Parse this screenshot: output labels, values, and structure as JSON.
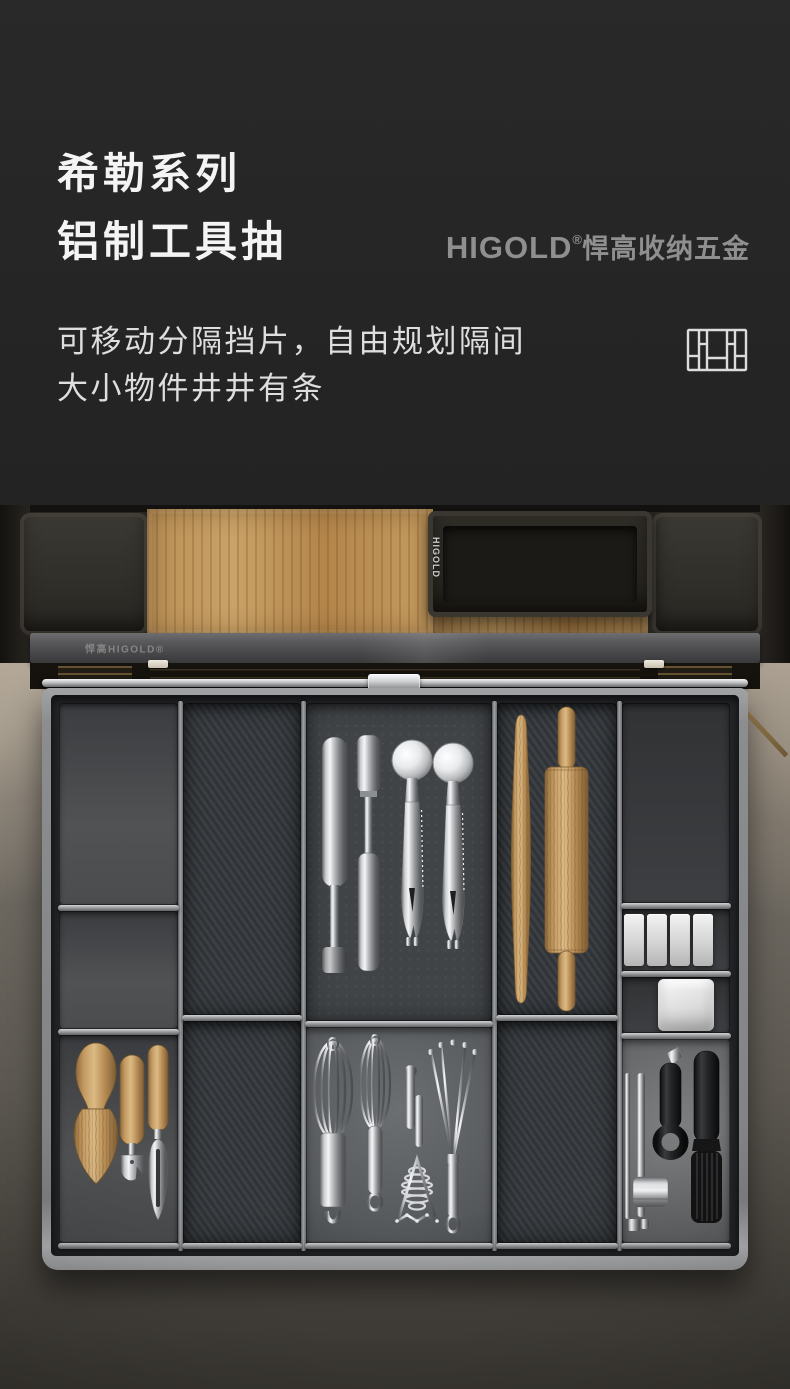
{
  "hero": {
    "title_line1": "希勒系列",
    "title_line2": "铝制工具抽",
    "brand_name": "HIGOLD",
    "brand_reg": "®",
    "brand_suffix": "悍高收纳五金",
    "desc_line1": "可移动分隔挡片，自由规划隔间",
    "desc_line2": "大小物件井井有条",
    "divider_icon": "drawer-divider-grid-icon",
    "colors": {
      "background": "#262626",
      "title": "#f4f4f4",
      "brand": "#8f8f8f",
      "desc": "#dedede"
    }
  },
  "photo": {
    "rail_brand": "悍高HIGOLD®",
    "tray_brand": "HIGOLD",
    "compartment_items": {
      "left_bottom": [
        "wooden-cheese-knife",
        "can-opener",
        "vegetable-peeler"
      ],
      "center_top": [
        "apple-corer",
        "corer",
        "ice-cream-scoop",
        "ice-cream-scoop"
      ],
      "center_bottom": [
        "balloon-whisk",
        "balloon-whisk",
        "spiral-masher",
        "fan-whisk"
      ],
      "pin_column": [
        "french-rolling-pin",
        "handled-rolling-pin"
      ],
      "right_column": [
        "white-block",
        "white-block",
        "white-block",
        "white-block",
        "white-square-tray",
        "garlic-press",
        "black-paring-knife",
        "silicone-basting-brush"
      ]
    },
    "colors": {
      "drawer_frame": "#8e9092",
      "compartment_dark": "#35393d",
      "mat_gray": "#6c6f72",
      "floor": "#6e6961",
      "wood": "#c79e68"
    }
  },
  "meta": {
    "width_px": 790,
    "height_px": 1389
  }
}
